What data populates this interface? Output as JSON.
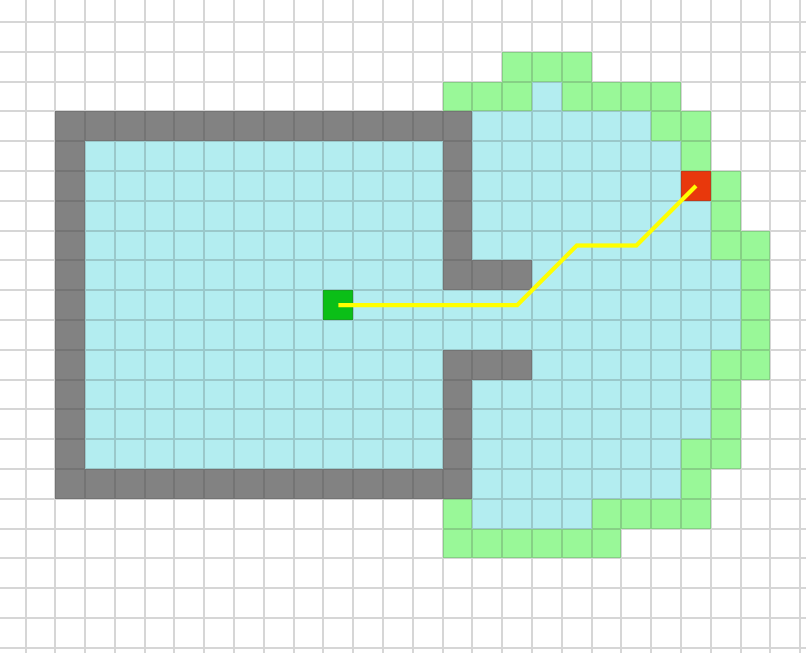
{
  "grid": {
    "cols": 28,
    "rows": 23,
    "cell_size": 29.8,
    "offset_x": -4.3,
    "offset_y": -7.8,
    "gridline_color": "rgba(70,70,70,0.22)",
    "legend": {
      "empty_color": "#ffffff",
      "explored_color": "#b3edf0",
      "frontier_color": "#99f898",
      "wall_color": "#828282",
      "goal_color": "#e8380c",
      "start_color": "#0bbf17"
    },
    "cell_types": {
      ".": "empty-cell",
      "C": "explored-cell",
      "G": "frontier-cell",
      "W": "wall-cell",
      "R": "goal-cell",
      "S": "start-cell"
    },
    "map": [
      "............................",
      "............................",
      ".................GGG........",
      "...............GGGCGGGG.....",
      "..WWWWWWWWWWWWWWCCCCCCGG....",
      "..WCCCCCCCCCCCCWCCCCCCCG....",
      "..WCCCCCCCCCCCCWCCCCCCCRG...",
      "..WCCCCCCCCCCCCWCCCCCCCCG...",
      "..WCCCCCCCCCCCCWCCCCCCCCGG..",
      "..WCCCCCCCCCCCCWWWCCCCCCCG..",
      "..WCCCCCCCCSCCCCCCCCCCCCCG..",
      "..WCCCCCCCCCCCCCCCCCCCCCCG..",
      "..WCCCCCCCCCCCCWWWCCCCCCGG..",
      "..WCCCCCCCCCCCCWCCCCCCCCG...",
      "..WCCCCCCCCCCCCWCCCCCCCCG...",
      "..WCCCCCCCCCCCCWCCCCCCCGG...",
      "..WWWWWWWWWWWWWWCCCCCCCG....",
      "...............GCCCCGGGG....",
      "...............GGGGGG.......",
      "............................",
      "............................",
      "............................",
      "............................"
    ],
    "start_cell": {
      "col": 11,
      "row": 10
    },
    "goal_cell": {
      "col": 23,
      "row": 6
    }
  },
  "path": {
    "color": "#ffff00",
    "stroke_width": 4.2,
    "waypoint_cells": [
      [
        11,
        10
      ],
      [
        17,
        10
      ],
      [
        19,
        8
      ],
      [
        21,
        8
      ],
      [
        23,
        6
      ]
    ]
  }
}
